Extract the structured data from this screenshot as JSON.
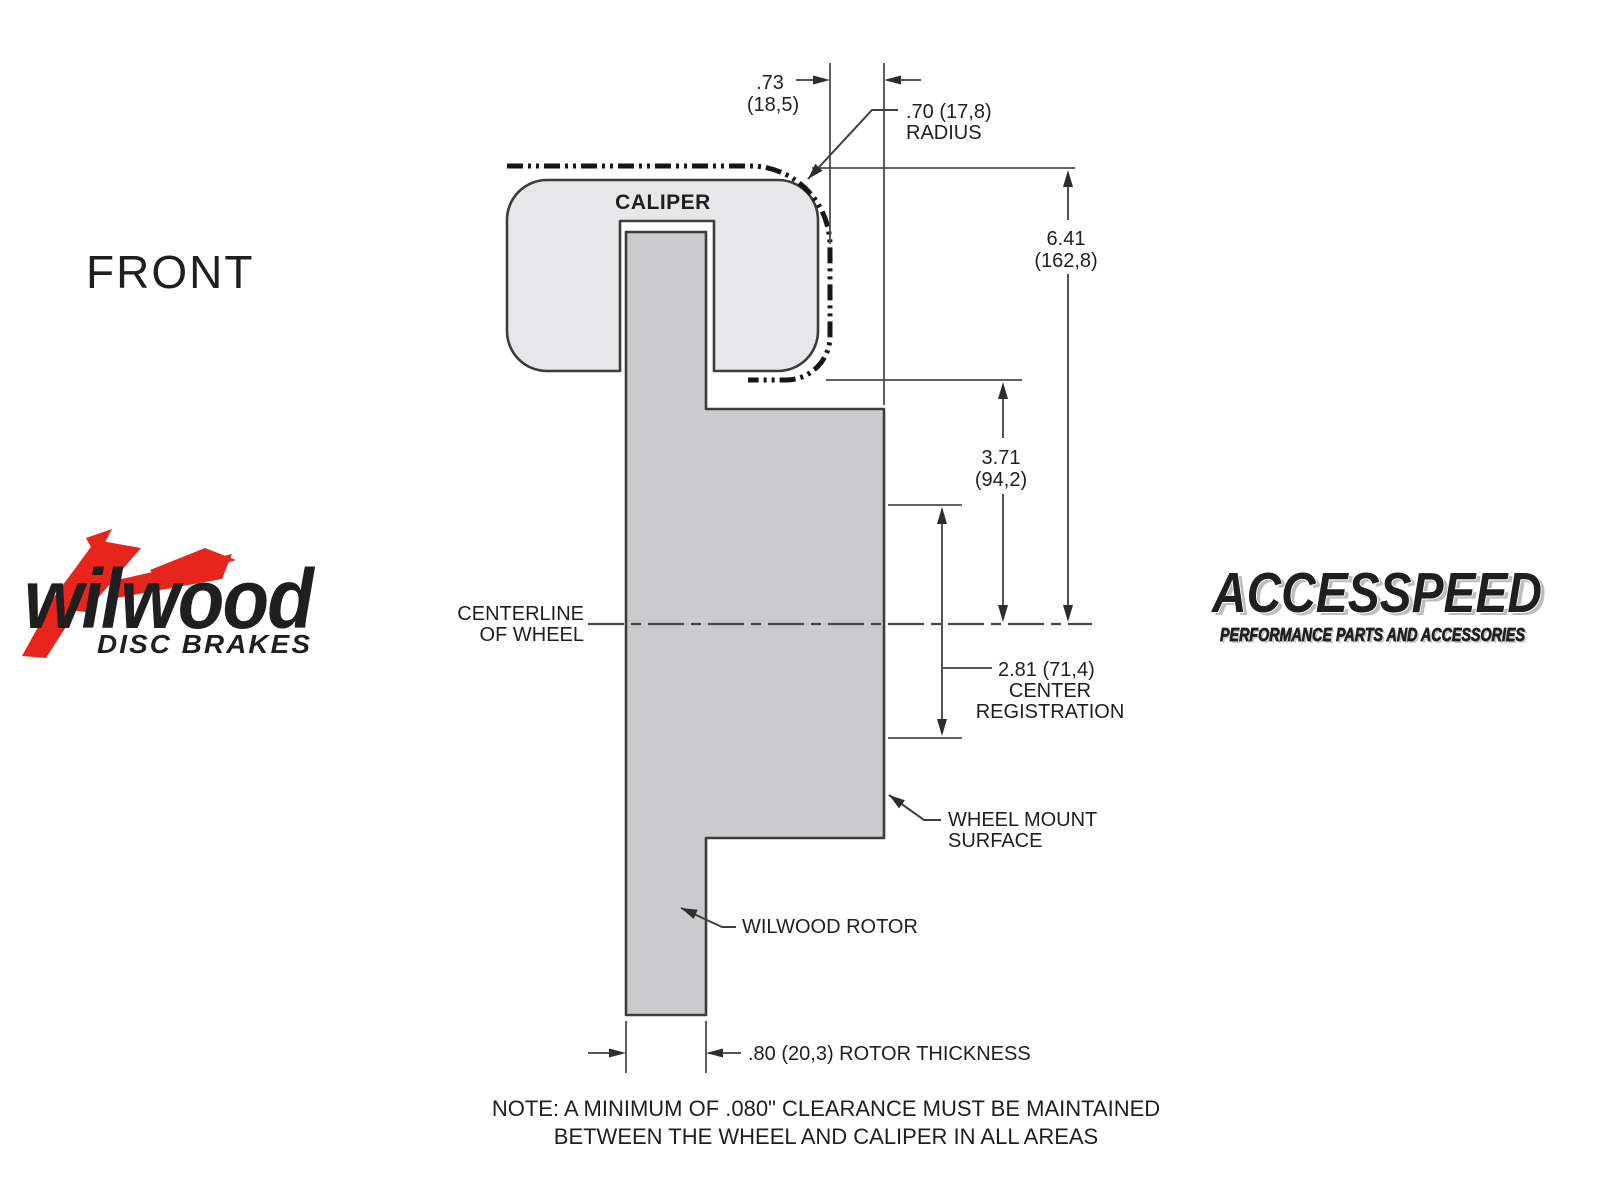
{
  "colors": {
    "caliper_fill": "#e7e7e9",
    "rotor_fill": "#cbcbce",
    "line_color": "#3c3c3c",
    "brand_red": "#e8251d"
  },
  "front_label": "FRONT",
  "diagram": {
    "caliper_label": "CALIPER",
    "centerline_line1": "CENTERLINE",
    "centerline_line2": "OF WHEEL",
    "dim_overhang_value": ".73",
    "dim_overhang_metric": "(18,5)",
    "radius_line1": ".70 (17,8)",
    "radius_line2": "RADIUS",
    "dim_caliper_height_value": "6.41",
    "dim_caliper_height_metric": "(162,8)",
    "dim_hat_depth_value": "3.71",
    "dim_hat_depth_metric": "(94,2)",
    "dim_center_reg_line1": "2.81 (71,4)",
    "dim_center_reg_line2": "CENTER",
    "dim_center_reg_line3": "REGISTRATION",
    "wheel_mount_line1": "WHEEL MOUNT",
    "wheel_mount_line2": "SURFACE",
    "rotor_label": "WILWOOD ROTOR",
    "rotor_thickness_label": ".80 (20,3) ROTOR THICKNESS",
    "note_line1": "NOTE: A MINIMUM OF .080\" CLEARANCE MUST BE MAINTAINED",
    "note_line2": "BETWEEN THE WHEEL AND CALIPER IN ALL AREAS"
  },
  "logos": {
    "wilwood_name": "wilwood",
    "wilwood_tagline": "DISC BRAKES",
    "accesspeed_name": "ACCESSPEED",
    "accesspeed_tagline": "PERFORMANCE PARTS AND ACCESSORIES"
  }
}
